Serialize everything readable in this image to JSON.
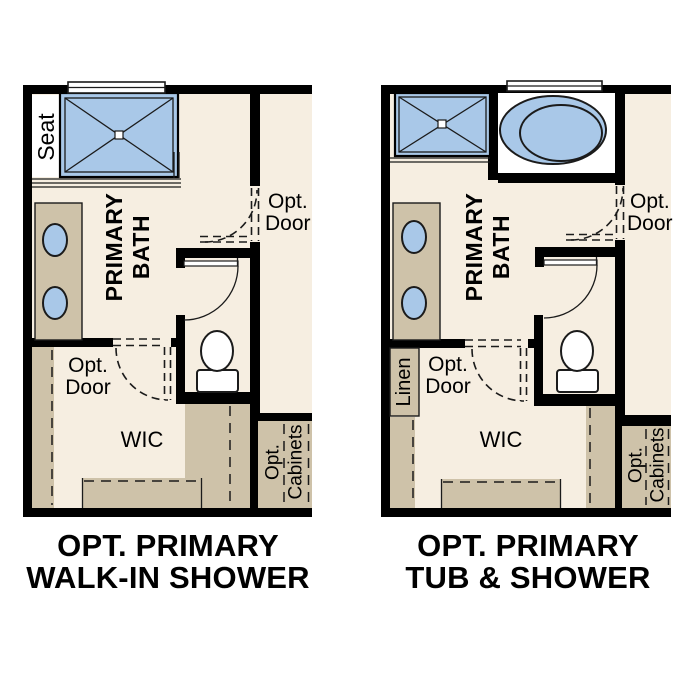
{
  "colors": {
    "wall": "#000000",
    "floor": "#f6eee1",
    "cabinet_tan": "#cec2a9",
    "fixture_blue": "#a9c8e8",
    "line": "#1b1b1b",
    "white": "#ffffff",
    "text": "#000000"
  },
  "plans": [
    {
      "name": "Opt. Primary Walk-In Shower",
      "caption": [
        "OPT. PRIMARY",
        "WALK-IN SHOWER"
      ],
      "labels": {
        "seat": "Seat",
        "room": [
          "PRIMARY",
          "BATH"
        ],
        "bath_door": [
          "Opt.",
          "Door"
        ],
        "wic_door": [
          "Opt.",
          "Door"
        ],
        "wic": "WIC",
        "cabinets": [
          "Opt.",
          "Cabinets"
        ]
      }
    },
    {
      "name": "Opt. Primary Tub & Shower",
      "caption": [
        "OPT. PRIMARY",
        "TUB & SHOWER"
      ],
      "labels": {
        "linen": "Linen",
        "room": [
          "PRIMARY",
          "BATH"
        ],
        "bath_door": [
          "Opt.",
          "Door"
        ],
        "wic_door": [
          "Opt.",
          "Door"
        ],
        "wic": "WIC",
        "cabinets": [
          "Opt.",
          "Cabinets"
        ]
      }
    }
  ]
}
